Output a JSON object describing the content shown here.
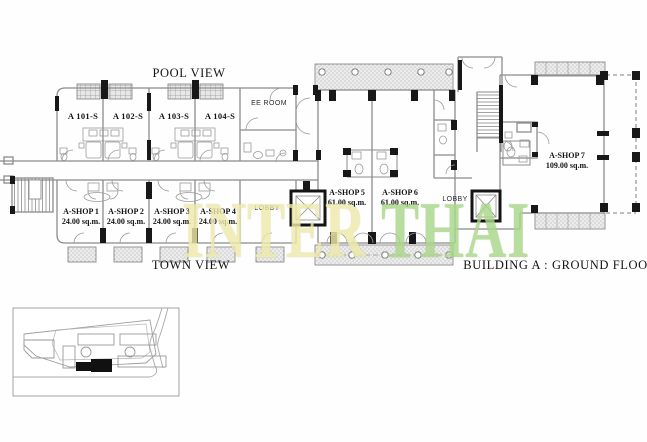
{
  "plan": {
    "title": "BUILDING A : GROUND FLOOR",
    "pool_view_label": "POOL VIEW",
    "town_view_label": "TOWN VIEW",
    "ee_room_label": "EE ROOM",
    "lobby_left_label": "LOBBY",
    "lobby_right_label": "LOBBY",
    "apartments": [
      {
        "label": "A 101-S"
      },
      {
        "label": "A 102-S"
      },
      {
        "label": "A 103-S"
      },
      {
        "label": "A 104-S"
      }
    ],
    "shops": [
      {
        "name": "A-SHOP 1",
        "area": "24.00 sq.m."
      },
      {
        "name": "A-SHOP 2",
        "area": "24.00 sq.m."
      },
      {
        "name": "A-SHOP 3",
        "area": "24.00 sq.m."
      },
      {
        "name": "A-SHOP 4",
        "area": "24.00 sq.m."
      },
      {
        "name": "A-SHOP 5",
        "area": "61.00 sq.m."
      },
      {
        "name": "A-SHOP 6",
        "area": "61.00 sq.m."
      },
      {
        "name": "A-SHOP 7",
        "area": "109.00 sq.m."
      }
    ]
  },
  "watermark": {
    "primary_text": "INTER",
    "secondary_text": "THAI",
    "primary_color": "#eeeaa9",
    "secondary_color": "#a9d78b"
  }
}
